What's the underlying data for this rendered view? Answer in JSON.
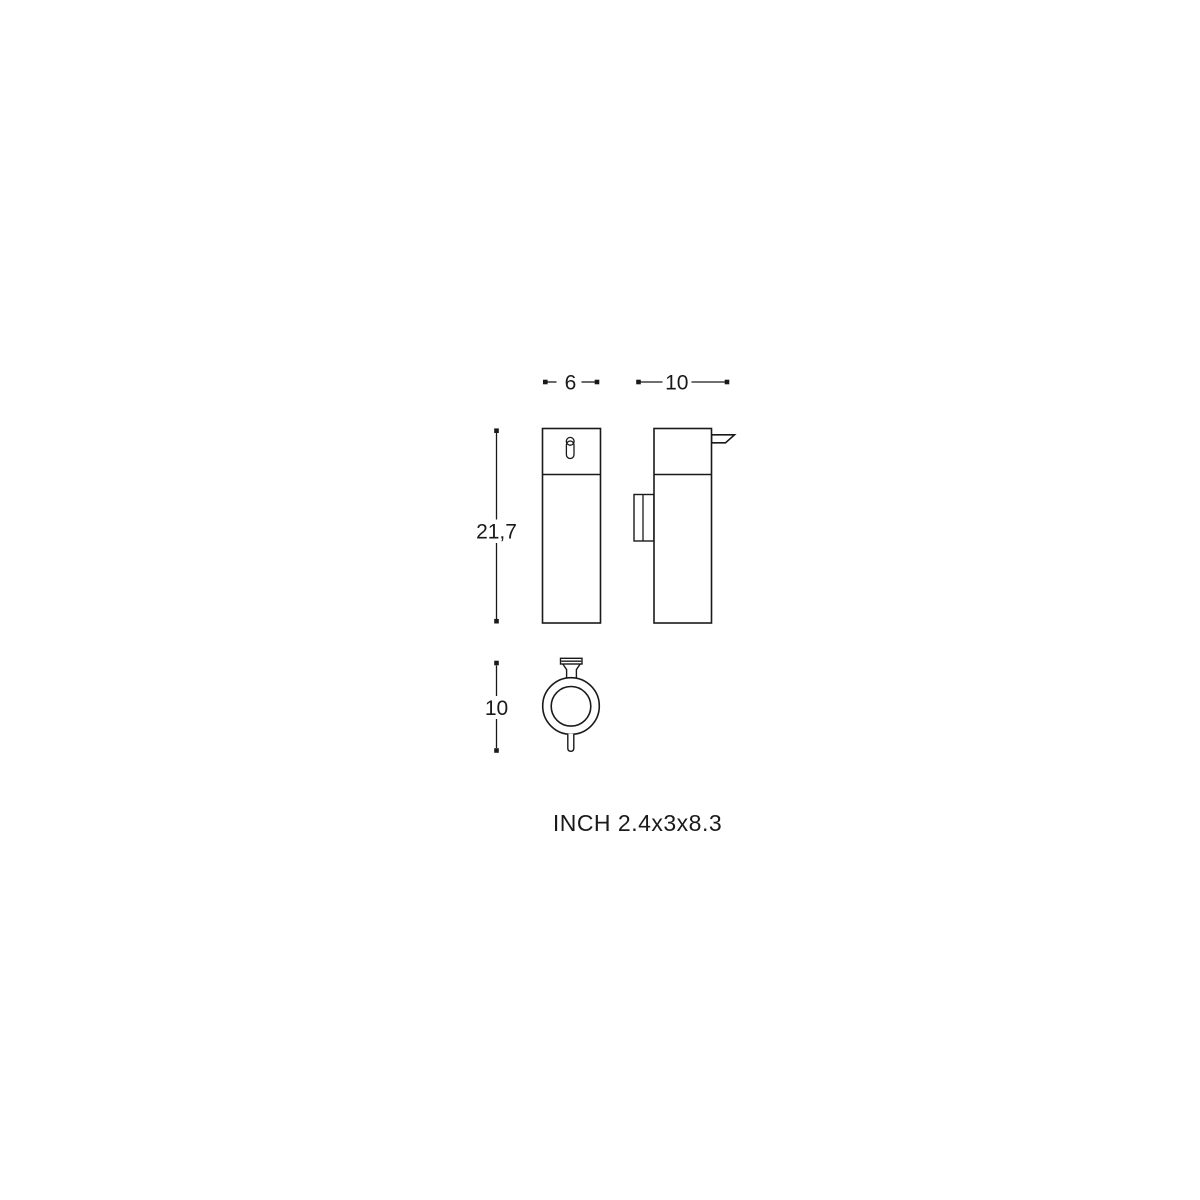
{
  "page": {
    "background": "#ffffff"
  },
  "drawing": {
    "line_color": "#1a1a1a",
    "caption": "INCH 2.4x3x8.3",
    "dims": {
      "front_width": "6",
      "side_depth": "10",
      "height": "21,7",
      "top_view_depth": "10"
    }
  }
}
